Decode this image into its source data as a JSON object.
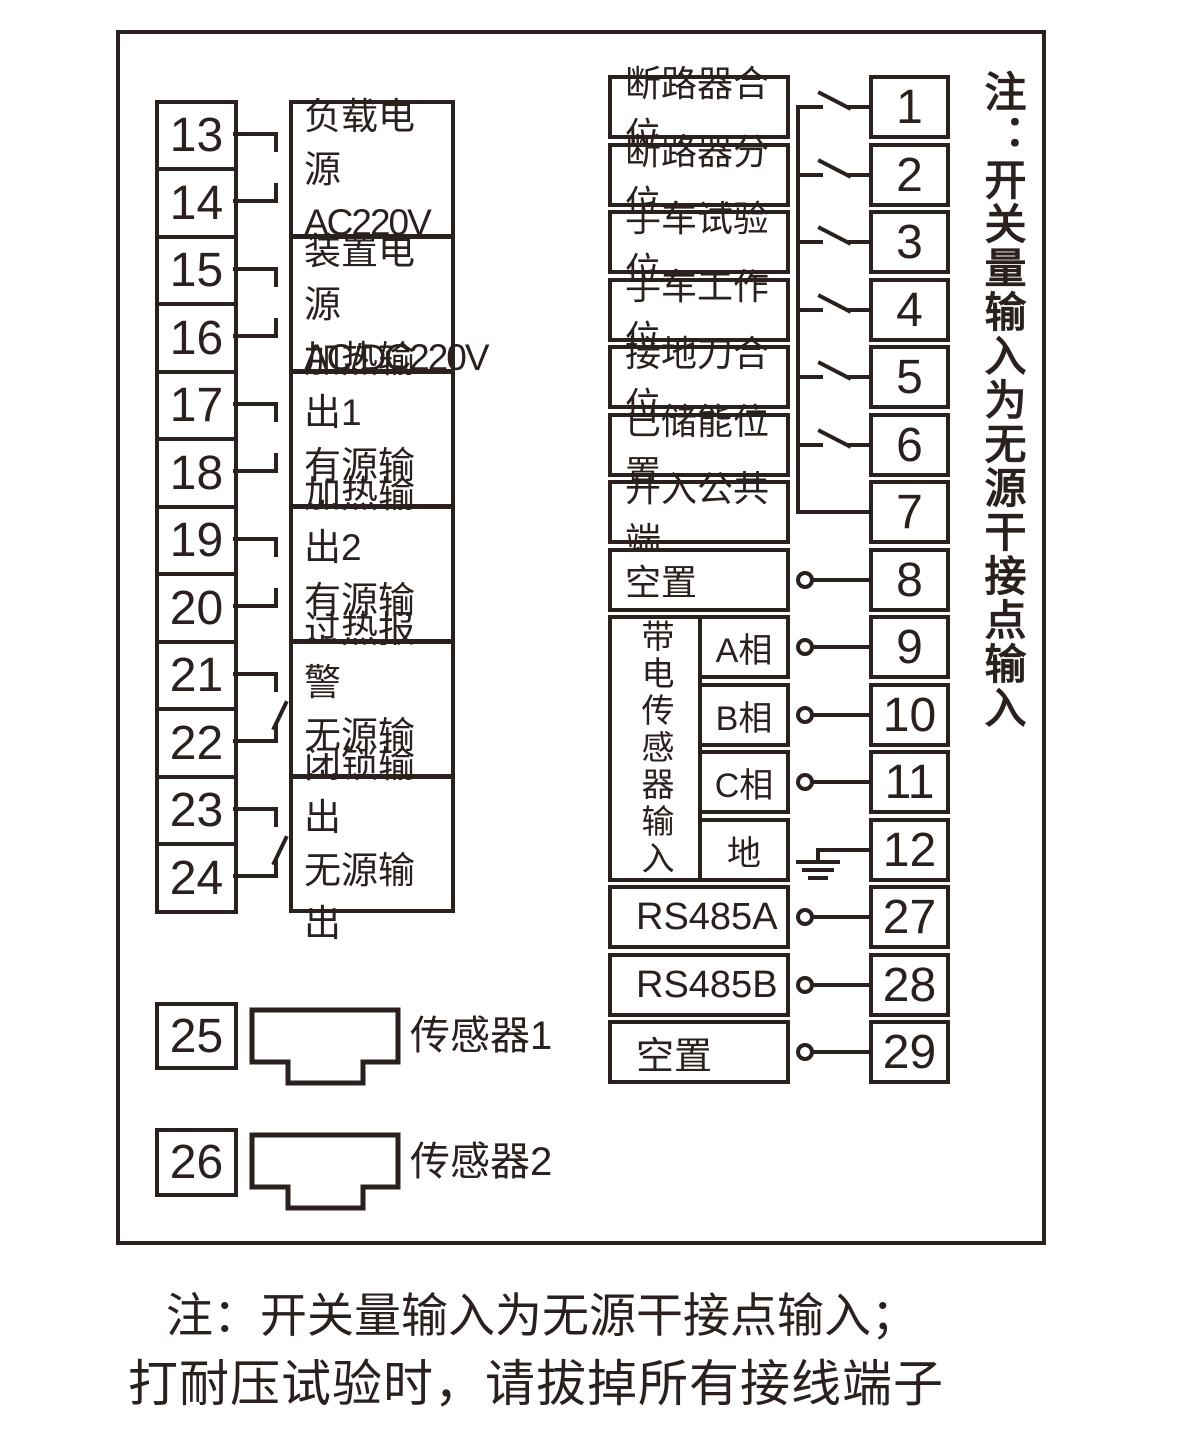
{
  "colors": {
    "ink": "#2a211e",
    "background": "#ffffff"
  },
  "left_panel": {
    "terminals": [
      "13",
      "14",
      "15",
      "16",
      "17",
      "18",
      "19",
      "20",
      "21",
      "22",
      "23",
      "24"
    ],
    "groups": [
      {
        "line1": "负载电源",
        "line2": "AC220V"
      },
      {
        "line1": "装置电源",
        "line2": "AC/DC220V"
      },
      {
        "line1": "加热输出1",
        "line2": "有源输出"
      },
      {
        "line1": "加热输出2",
        "line2": "有源输出"
      },
      {
        "line1": "过热报警",
        "line2": "无源输出"
      },
      {
        "line1": "闭锁输出",
        "line2": "无源输出"
      }
    ],
    "sensors": [
      {
        "terminal": "25",
        "label": "传感器1"
      },
      {
        "terminal": "26",
        "label": "传感器2"
      }
    ]
  },
  "right_panel": {
    "rows": [
      {
        "label": "断路器合位",
        "terminal": "1"
      },
      {
        "label": "断路器分位",
        "terminal": "2"
      },
      {
        "label": "手车试验位",
        "terminal": "3"
      },
      {
        "label": "手车工作位",
        "terminal": "4"
      },
      {
        "label": "接地刀合位",
        "terminal": "5"
      },
      {
        "label": "已储能位置",
        "terminal": "6"
      },
      {
        "label": "开入公共端",
        "terminal": "7"
      },
      {
        "label": "空置",
        "terminal": "8"
      }
    ],
    "sensor_block": {
      "label": "带电传感器输入",
      "phases": [
        {
          "label": "A相",
          "terminal": "9"
        },
        {
          "label": "B相",
          "terminal": "10"
        },
        {
          "label": "C相",
          "terminal": "11"
        },
        {
          "label": "地",
          "terminal": "12"
        }
      ]
    },
    "comm_rows": [
      {
        "label": "RS485A",
        "terminal": "27"
      },
      {
        "label": "RS485B",
        "terminal": "28"
      },
      {
        "label": "空置",
        "terminal": "29"
      }
    ],
    "side_note": "注：开关量输入为无源干接点输入"
  },
  "footer": {
    "note_line1": "注：开关量输入为无源干接点输入；",
    "note_line2": "打耐压试验时，请拔掉所有接线端子"
  }
}
